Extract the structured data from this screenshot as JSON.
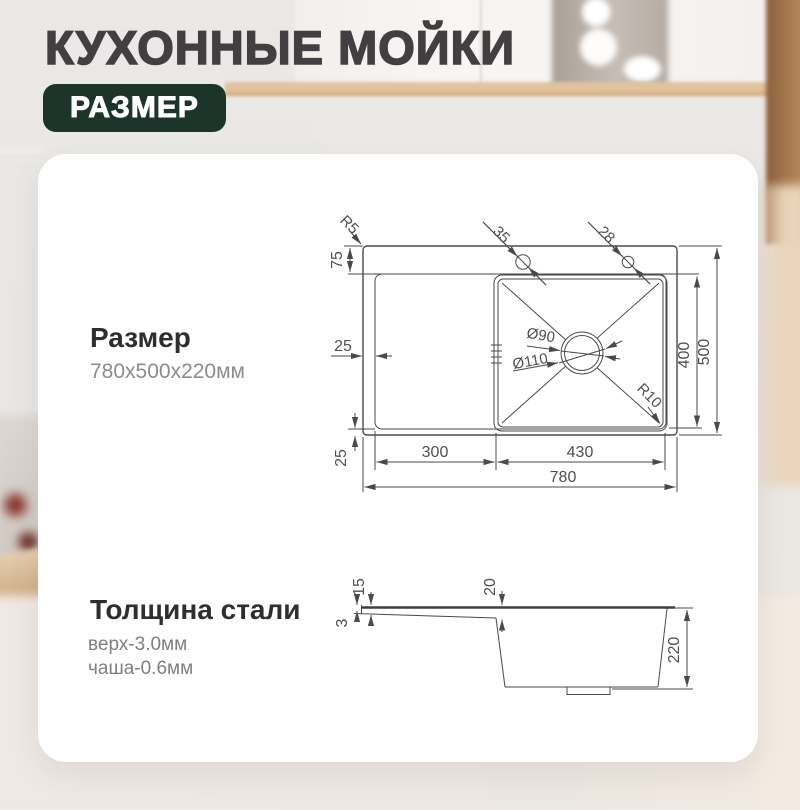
{
  "header": {
    "title": "КУХОННЫЕ МОЙКИ",
    "badge": "РАЗМЕР"
  },
  "size": {
    "heading": "Размер",
    "value": "780x500x220мм"
  },
  "thickness": {
    "heading": "Толщина стали",
    "top": "верх-3.0мм",
    "bowl": "чаша-0.6мм"
  },
  "plan": {
    "deck_corner_radius": "R5",
    "hole1_diameter": "35",
    "hole2_diameter": "28",
    "deck_height": "75",
    "left_margin": "25",
    "bottom_margin": "25",
    "drainboard_width": "300",
    "bowl_width": "430",
    "total_width": "780",
    "bowl_depth": "400",
    "total_depth": "500",
    "bowl_corner_radius": "R10",
    "drain_inner_diameter": "Ø90",
    "drain_outer_diameter": "Ø110"
  },
  "section": {
    "deck_thickness": "3",
    "rim_height": "15",
    "bowl_offset": "20",
    "total_height": "220"
  },
  "colors": {
    "badge_bg": "#1d342b",
    "title_text": "#413f41",
    "heading_text": "#2e2e2e",
    "secondary_text": "#8c8c8c",
    "drawing_line": "#4a4a4a",
    "card_bg": "#ffffff"
  }
}
